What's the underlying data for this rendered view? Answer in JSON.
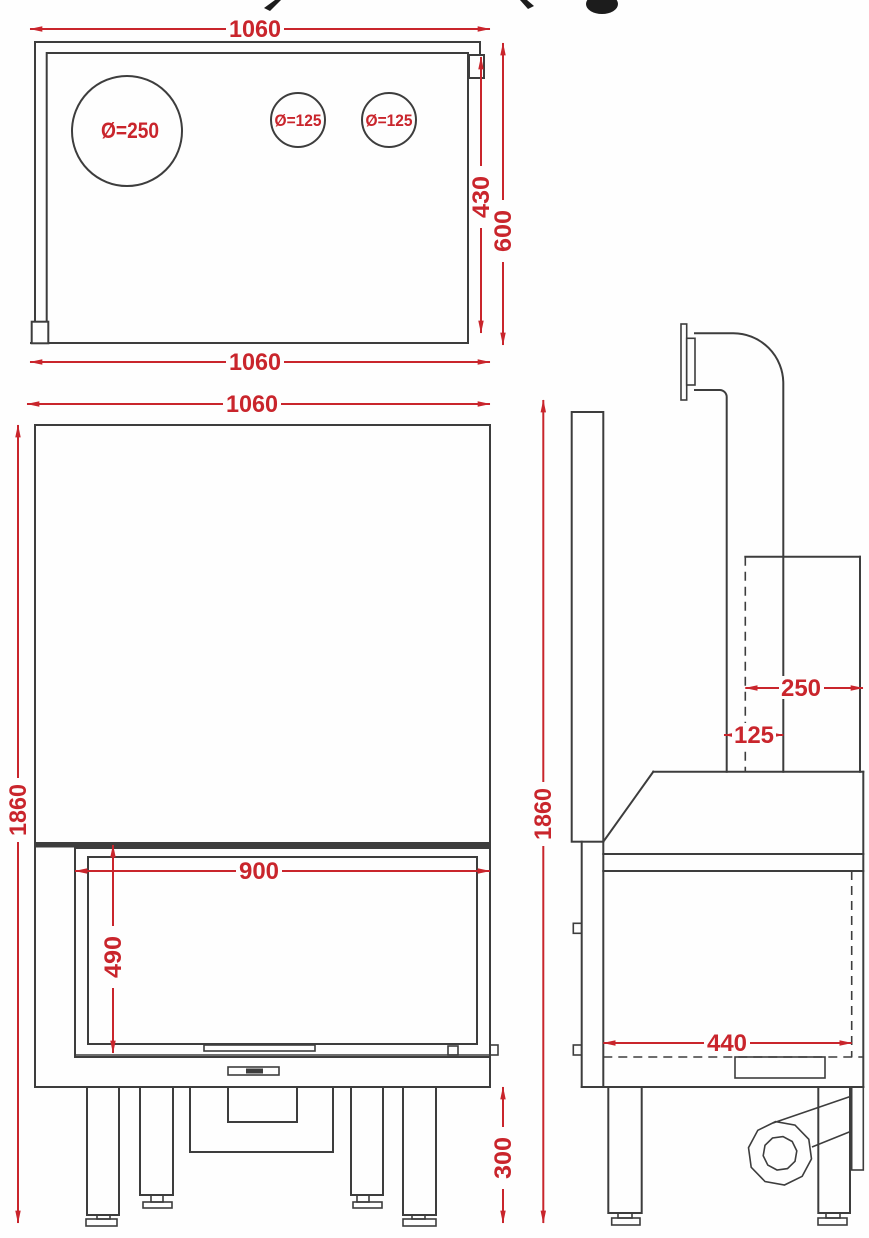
{
  "page": {
    "background": "#fefefe"
  },
  "colors": {
    "line": "#3d3d3d",
    "dimension_red": "#c9252c"
  },
  "top_view": {
    "dim_width_top": "1060",
    "dim_width_bottom": "1060",
    "dim_depth_inner": "430",
    "dim_depth_total": "600",
    "flue_hole_label": "Ø=250",
    "left_air_hole_label": "Ø=125",
    "right_air_hole_label": "Ø=125"
  },
  "front_view": {
    "dim_width": "1060",
    "dim_total_height": "1860",
    "dim_glass_width": "900",
    "dim_glass_height": "490",
    "dim_leg_height": "300"
  },
  "side_view": {
    "dim_total_height": "1860",
    "dim_flue_pipe_width": "250",
    "dim_flue_offset": "125",
    "dim_inner_depth": "440"
  }
}
